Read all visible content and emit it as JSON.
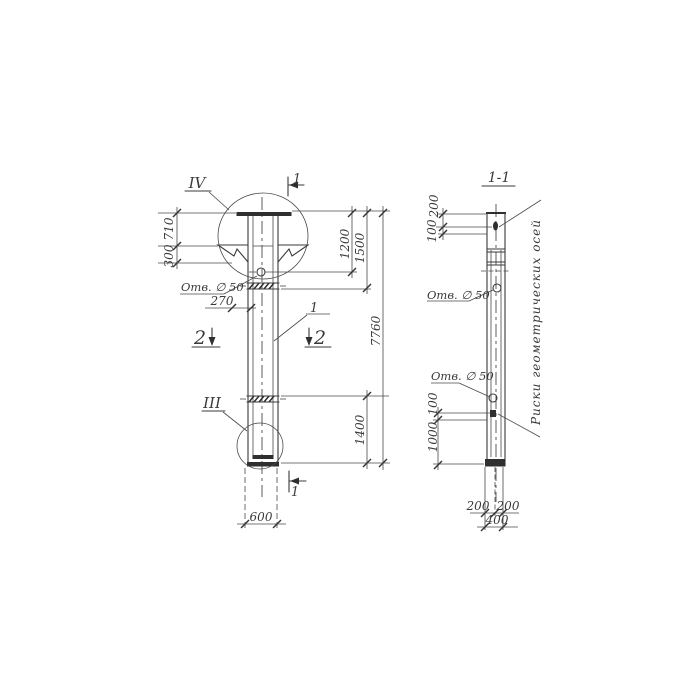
{
  "sheet": {
    "background": "#ffffff",
    "ink": "#3a3a3a"
  },
  "labels": {
    "detail_top": "IV",
    "detail_bottom": "III",
    "section_cut": "1",
    "section_cut_2": "2",
    "part_callout": "1",
    "section_title": "1-1"
  },
  "front_view": {
    "dims": {
      "plate_to_corbel": "710",
      "corbel_height": "300",
      "hole_edge_offset": "270",
      "column_width": "600",
      "top_to_hole": "1200",
      "top_to_joint": "1500",
      "overall_length": "7760",
      "tip_segment": "1400"
    },
    "hole_note": "Отв. ∅ 50"
  },
  "section_view": {
    "dims": {
      "top_to_mark": "200",
      "mark_inset": "100",
      "hole_to_mark": "100",
      "mark_to_tip": "1000",
      "bottom_left": "200",
      "bottom_right": "200",
      "bottom_total": "400"
    },
    "hole_note_upper": "Отв. ∅ 50",
    "hole_note_lower": "Отв. ∅ 50",
    "axes_note": "Риски геометрических осей"
  }
}
